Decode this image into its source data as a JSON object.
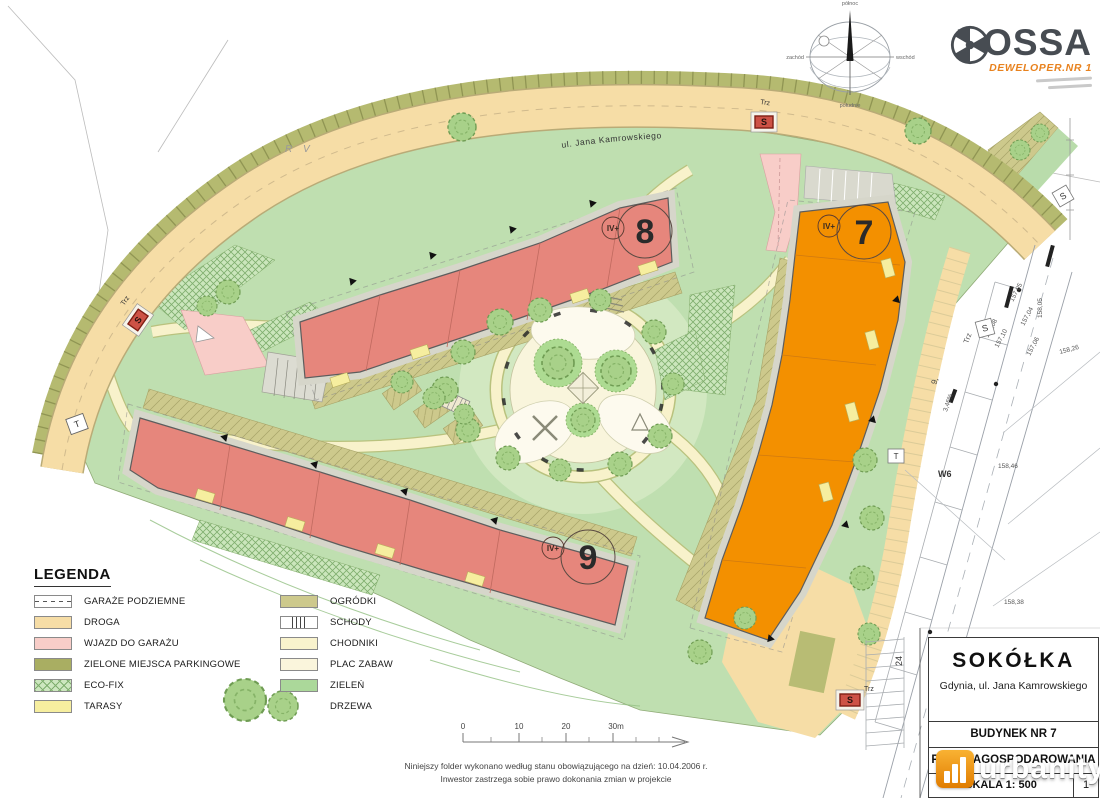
{
  "branding": {
    "logo_text": "HOSSA",
    "tagline": "DEWELOPER.NR 1"
  },
  "compass": {
    "north": "północ",
    "south": "południe",
    "west": "zachód",
    "east": "wschód"
  },
  "map": {
    "street_label": "ul. Jana Kamrowskiego",
    "area_label_rv": "R V",
    "buildings": [
      {
        "number": "8",
        "storeys": "IV+"
      },
      {
        "number": "7",
        "storeys": "IV+"
      },
      {
        "number": "9",
        "storeys": "IV+"
      }
    ],
    "markers": {
      "s": "S",
      "t": "T",
      "trz": "Trz",
      "w6": "W6",
      "row24": "24",
      "plot9": "9,",
      "slope": "3,46%"
    },
    "elevations": [
      "157,05",
      "157,08",
      "157,10",
      "157,04",
      "157,06",
      "158,26",
      "158,46",
      "158,38",
      "158,05"
    ]
  },
  "legend": {
    "title": "LEGENDA",
    "left": [
      "GARAŻE PODZIEMNE",
      "DROGA",
      "WJAZD DO GARAŻU",
      "ZIELONE MIEJSCA PARKINGOWE",
      "ECO-FIX",
      "TARASY"
    ],
    "right": [
      "OGRÓDKI",
      "SCHODY",
      "CHODNIKI",
      "PLAC ZABAW",
      "ZIELEŃ",
      "DRZEWA"
    ]
  },
  "scalebar": {
    "t0": "0",
    "t1": "10",
    "t2": "20",
    "t3": "30m"
  },
  "notes": {
    "line1": "Niniejszy folder wykonano według stanu obowiązującego na dzień: 10.04.2006 r.",
    "line2": "Inwestor zastrzega sobie prawo dokonania zmian w projekcie"
  },
  "titleblock": {
    "project": "SOKÓŁKA",
    "address": "Gdynia, ul. Jana Kamrowskiego",
    "building": "BUDYNEK NR 7",
    "drawing": "PLAN ZAGOSPODAROWANIA",
    "scale": "SKALA 1: 500",
    "sheet": "1"
  },
  "watermark": {
    "name": "urbanity",
    "tld": ".pl"
  },
  "colors": {
    "building_red": "#e6867c",
    "building_orange": "#f39000",
    "road": "#f6dda6",
    "green": "#bfdfb0",
    "parking_strip": "#b5ba70",
    "entry_pink": "#f8cdc8"
  }
}
